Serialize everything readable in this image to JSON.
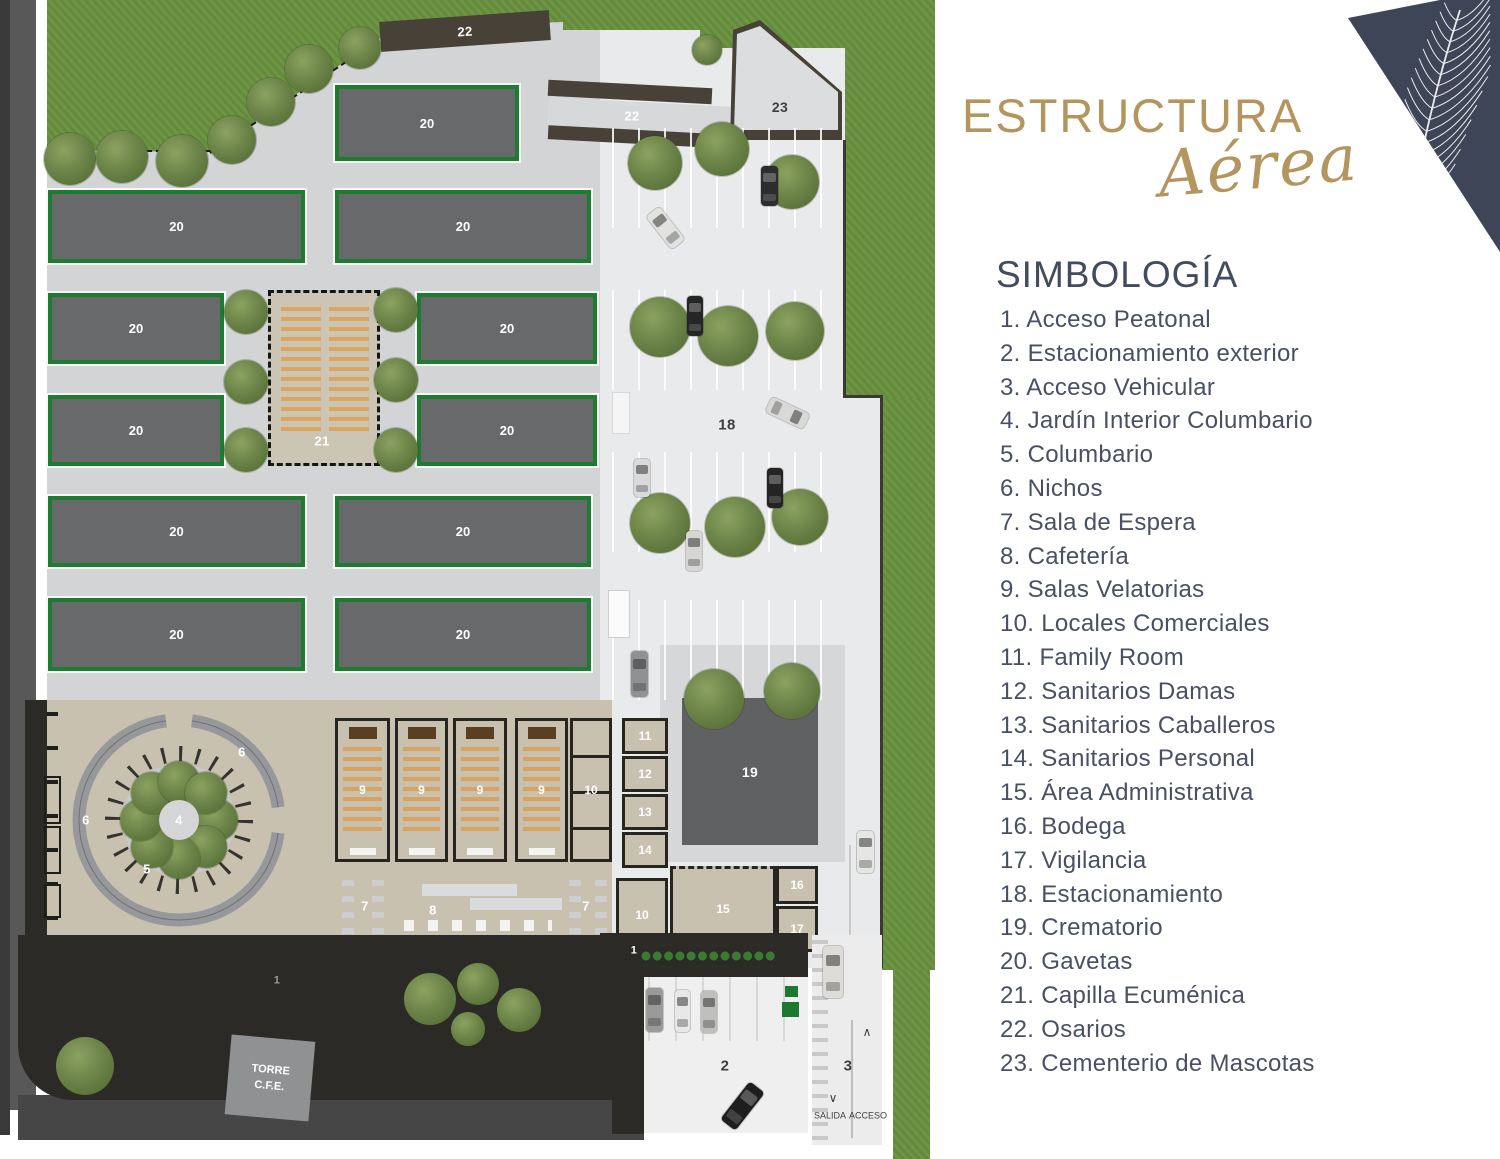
{
  "brand": {
    "title": "ESTRUCTURA",
    "subtitle": "Aérea",
    "gold": "#b4955e",
    "navy": "#3e4557"
  },
  "legend": {
    "heading": "SIMBOLOGÍA",
    "text_color": "#4a5064",
    "items": [
      "1. Acceso Peatonal",
      "2. Estacionamiento exterior",
      "3. Acceso Vehicular",
      "4. Jardín Interior Columbario",
      "5. Columbario",
      "6. Nichos",
      "7. Sala de Espera",
      "8. Cafetería",
      "9. Salas Velatorias",
      "10. Locales Comerciales",
      "11. Family Room",
      "12. Sanitarios Damas",
      "13. Sanitarios Caballeros",
      "14. Sanitarios Personal",
      "15. Área Administrativa",
      "16. Bodega",
      "17. Vigilancia",
      "18. Estacionamiento",
      "19. Crematorio",
      "20. Gavetas",
      "21. Capilla Ecuménica",
      "22. Osarios",
      "23. Cementerio de Mascotas"
    ]
  },
  "plan": {
    "colors": {
      "grass": "#69913f",
      "plaza": "#d2d4d6",
      "parking": "#e9eaeb",
      "gaveta_fill": "#67696b",
      "gaveta_border": "#1e7c31",
      "building": "#c8c1b0",
      "road_dark": "#2c2a27"
    },
    "labels": {
      "acceso_peatonal": "1",
      "est_exterior": "2",
      "acc_vehicular": "3",
      "jardin": "4",
      "columbario": "5",
      "nichos": "6",
      "espera": "7",
      "cafeteria": "8",
      "velatorias": "9",
      "locales": "10",
      "family": "11",
      "s_damas": "12",
      "s_caballeros": "13",
      "s_personal": "14",
      "admin": "15",
      "bodega": "16",
      "vigilancia": "17",
      "estacionamiento": "18",
      "crematorio": "19",
      "gavetas": "20",
      "capilla": "21",
      "osarios": "22",
      "mascotas": "23",
      "salida": "SALIDA",
      "acceso": "ACCESO",
      "torre_l1": "TORRE",
      "torre_l2": "C.F.E."
    }
  }
}
